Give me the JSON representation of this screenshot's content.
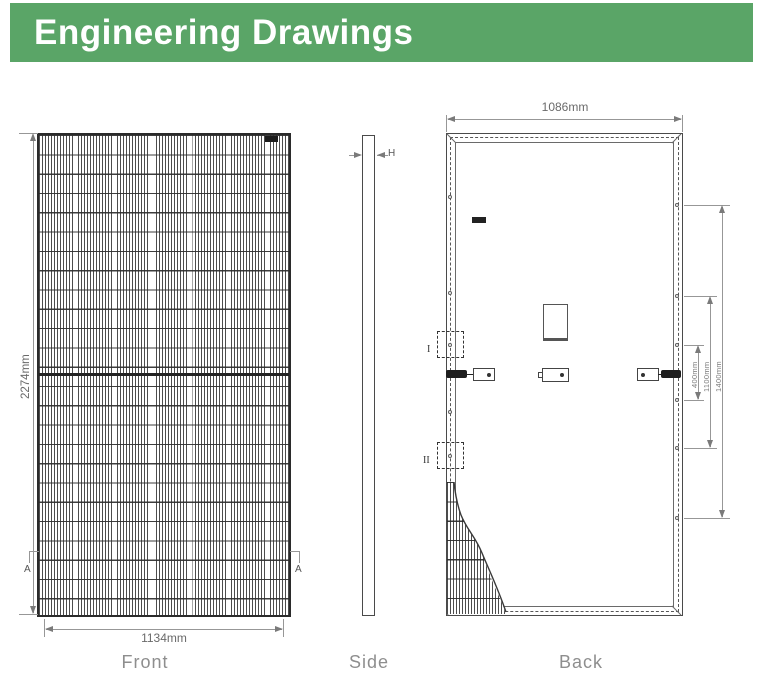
{
  "header": {
    "title": "Engineering Drawings",
    "bg_color": "#5aa567",
    "text_color": "#ffffff"
  },
  "front": {
    "label": "Front",
    "height_dim": "2274mm",
    "width_dim": "1134mm",
    "section_marker_left": "A",
    "section_marker_right": "A"
  },
  "side": {
    "label": "Side",
    "thickness_label": "H"
  },
  "back": {
    "label": "Back",
    "width_dim": "1086mm",
    "detail_marker_1": "I",
    "detail_marker_2": "II",
    "mount_dim_inner": "400mm",
    "mount_dim_middle": "1100mm",
    "mount_dim_outer": "1400mm"
  },
  "colors": {
    "line_dark": "#2b2b2b",
    "dim_gray": "#979797",
    "label_gray": "#8e8e8e"
  }
}
